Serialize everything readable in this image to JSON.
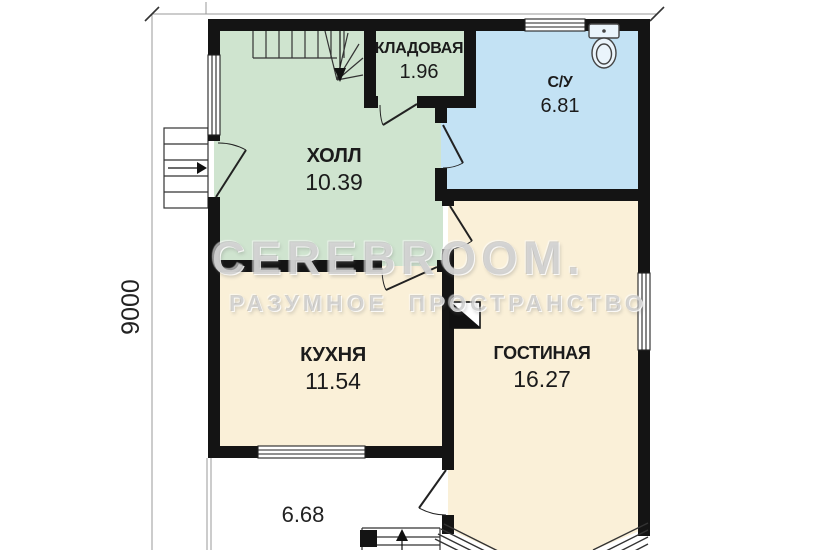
{
  "rooms": [
    {
      "name": "КЛАДОВАЯ",
      "area": "1.96"
    },
    {
      "name": "С/У",
      "area": "6.81"
    },
    {
      "name": "ХОЛЛ",
      "area": "10.39"
    },
    {
      "name": "КУХНЯ",
      "area": "11.54"
    },
    {
      "name": "ГОСТИНАЯ",
      "area": "16.27"
    }
  ],
  "terrace": {
    "area": "6.68"
  },
  "dimensions": {
    "side": "9000"
  },
  "watermark": {
    "brand": "CEREBROOM.",
    "tagline": "РАЗУМНОЕ  ПРОСТРАНСТВО"
  },
  "colors": {
    "wall": "#141414",
    "hall": "#cfe4cf",
    "bathroom": "#c3e2f4",
    "living": "#faf0d8",
    "dimension_line": "#999999"
  }
}
